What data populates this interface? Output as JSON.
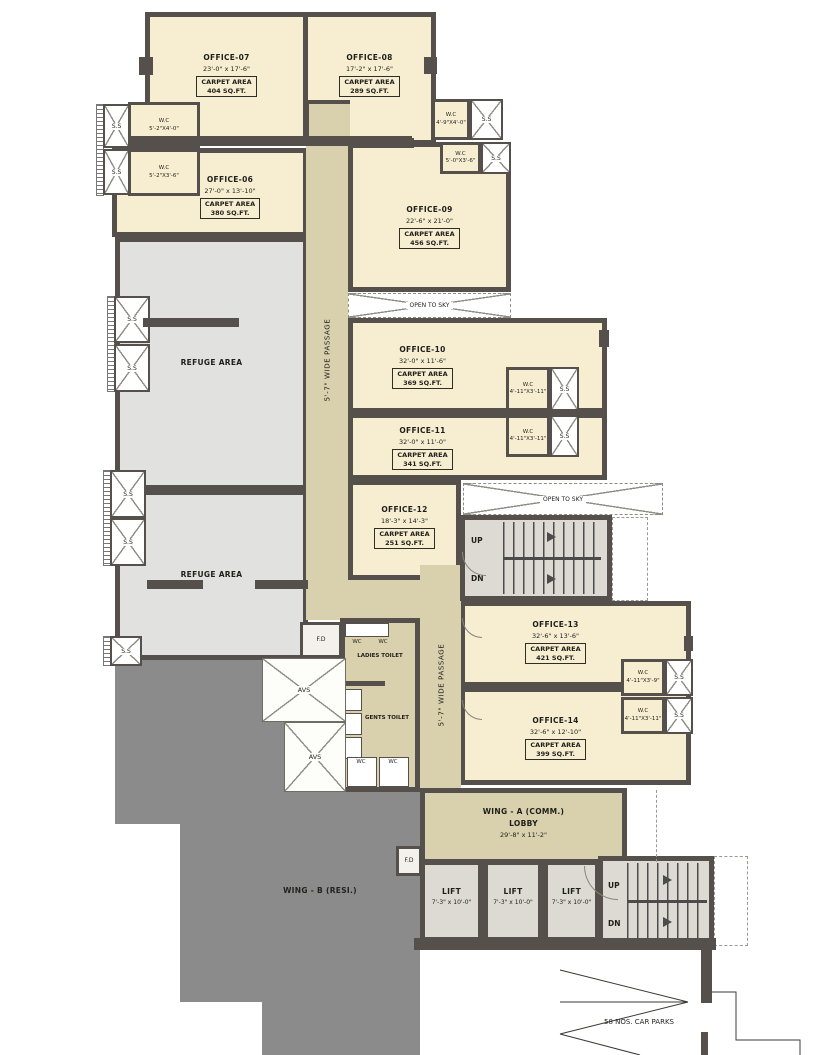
{
  "plan": {
    "carpet_label": "CARPET AREA",
    "offices": [
      {
        "name": "OFFICE-07",
        "dims": "23'-0\" x 17'-6\"",
        "area": "404 SQ.FT."
      },
      {
        "name": "OFFICE-08",
        "dims": "17'-2\" x 17'-6\"",
        "area": "289 SQ.FT."
      },
      {
        "name": "OFFICE-06",
        "dims": "27'-0\" x 13'-10\"",
        "area": "380 SQ.FT."
      },
      {
        "name": "OFFICE-09",
        "dims": "22'-6\" x 21'-0\"",
        "area": "456 SQ.FT."
      },
      {
        "name": "OFFICE-10",
        "dims": "32'-0\" x 11'-6\"",
        "area": "369 SQ.FT."
      },
      {
        "name": "OFFICE-11",
        "dims": "32'-0\" x 11'-0\"",
        "area": "341 SQ.FT."
      },
      {
        "name": "OFFICE-12",
        "dims": "18'-3\" x 14'-3\"",
        "area": "251 SQ.FT."
      },
      {
        "name": "OFFICE-13",
        "dims": "32'-6\" x 13'-6\"",
        "area": "421 SQ.FT."
      },
      {
        "name": "OFFICE-14",
        "dims": "32'-6\" x 12'-10\"",
        "area": "399 SQ.FT."
      }
    ],
    "wcs": [
      {
        "label": "W.C",
        "dims": "5'-2\"X4'-0\""
      },
      {
        "label": "W.C",
        "dims": "5'-2\"X3'-6\""
      },
      {
        "label": "W.C",
        "dims": "4'-9\"X4'-0\""
      },
      {
        "label": "W.C",
        "dims": "5'-0\"X3'-6\""
      },
      {
        "label": "W.C",
        "dims": "4'-11\"X3'-11\""
      },
      {
        "label": "W.C",
        "dims": "4'-11\"X3'-11\""
      },
      {
        "label": "W.C",
        "dims": "4'-11\"X3'-9\""
      },
      {
        "label": "W.C",
        "dims": "4'-11\"X3'-11\""
      }
    ],
    "labels": {
      "refuge": "REFUGE AREA",
      "open_to_sky": "OPEN TO SKY",
      "passage": "5'-7\" WIDE PASSAGE",
      "up": "UP",
      "dn": "DN",
      "lift": "LIFT",
      "lift_dims": "7'-3\" x 10'-0\"",
      "ladies_toilet": "LADIES TOILET",
      "gents_toilet": "GENTS TOILET",
      "ss": "S.S",
      "fd": "F.D",
      "avs": "AVS",
      "wc_small": "WC",
      "wing_a_line1": "WING - A (COMM.)",
      "wing_a_line2": "LOBBY",
      "wing_a_line3": "29'-8\" x 11'-2\"",
      "wing_b": "WING - B (RESI.)",
      "car_parks": "58 NOS. CAR PARKS"
    },
    "colors": {
      "wall": "#55504b",
      "office": "#f7eed2",
      "passage": "#d9d0ae",
      "refuge": "#e1e1df",
      "stair": "#dcdad3",
      "wing_b": "#8b8b8b"
    }
  }
}
